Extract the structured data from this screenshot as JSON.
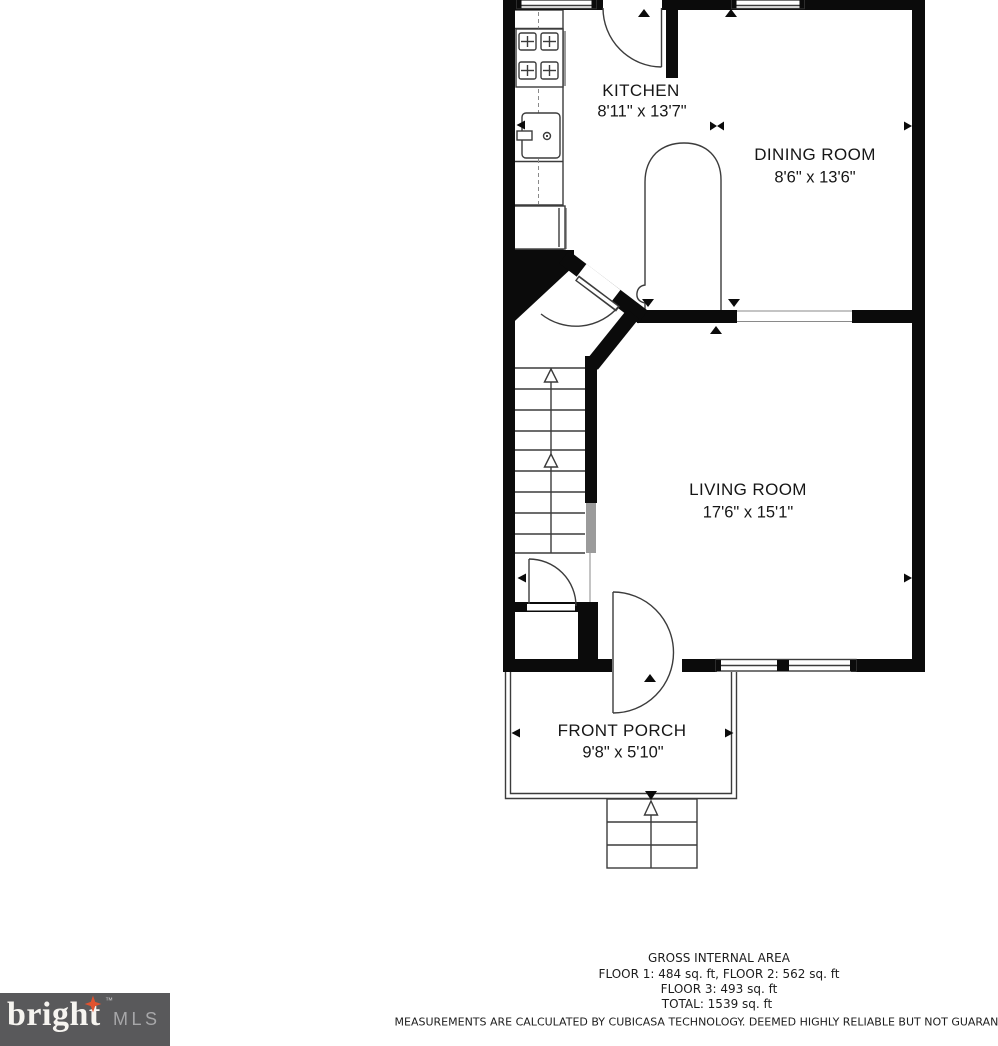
{
  "colors": {
    "bg": "#ffffff",
    "wall": "#0b0b0b",
    "line": "#3c3c3c",
    "light_line": "#8a8a8a",
    "gray_wall": "#9b9b9b",
    "text": "#161616",
    "logo_bg": "#59595b",
    "logo_star": "#e0532f"
  },
  "rooms": [
    {
      "name": "KITCHEN",
      "dims": "8'11\" x 13'7\""
    },
    {
      "name": "DINING ROOM",
      "dims": "8'6\" x 13'6\""
    },
    {
      "name": "LIVING ROOM",
      "dims": "17'6\" x 15'1\""
    },
    {
      "name": "FRONT PORCH",
      "dims": "9'8\" x 5'10\""
    }
  ],
  "area_summary": {
    "title": "GROSS INTERNAL AREA",
    "line1": "FLOOR 1: 484 sq. ft, FLOOR 2: 562 sq. ft",
    "line2": "FLOOR 3: 493 sq. ft",
    "line3": "TOTAL: 1539 sq. ft",
    "disclaimer": "MEASUREMENTS ARE CALCULATED BY CUBICASA TECHNOLOGY. DEEMED HIGHLY RELIABLE BUT NOT GUARANTEED"
  },
  "logo": {
    "brand": "bright",
    "tm": "™",
    "suffix": "MLS"
  }
}
